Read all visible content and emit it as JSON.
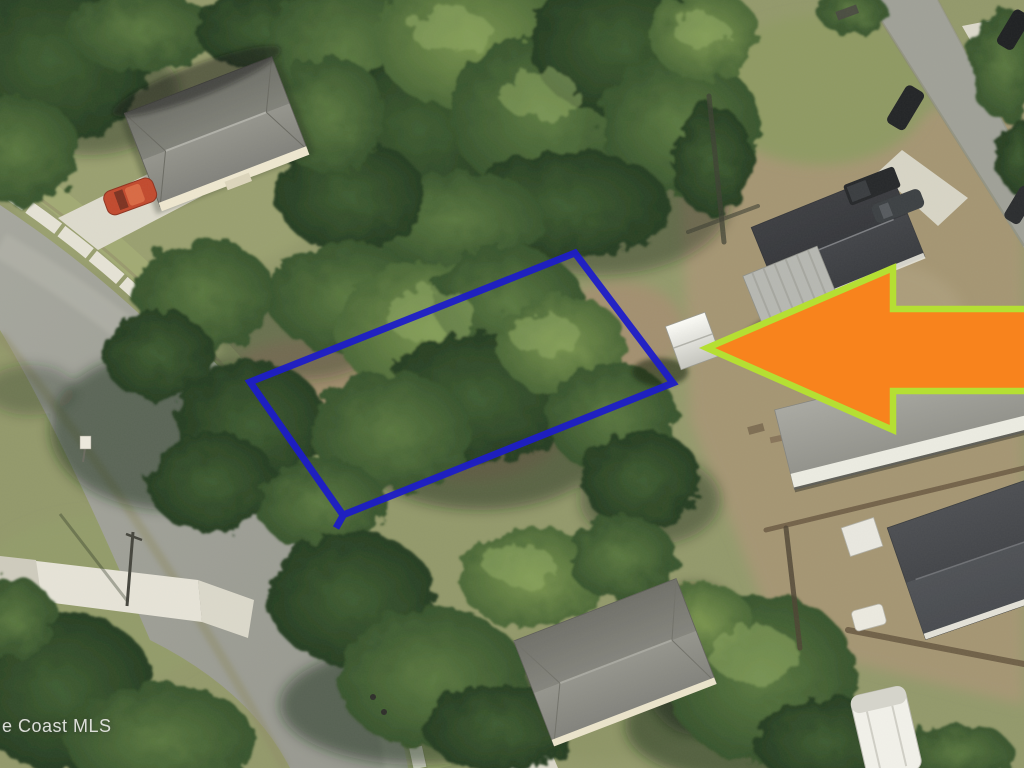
{
  "watermark": {
    "text": "e Coast MLS"
  },
  "annotations": {
    "parcel_outline": {
      "color": "#1d1dc7",
      "shape": "rotated-rectangle"
    },
    "arrow": {
      "fill_color": "#f8831d",
      "outline_color": "#b5df33",
      "direction": "left"
    }
  }
}
